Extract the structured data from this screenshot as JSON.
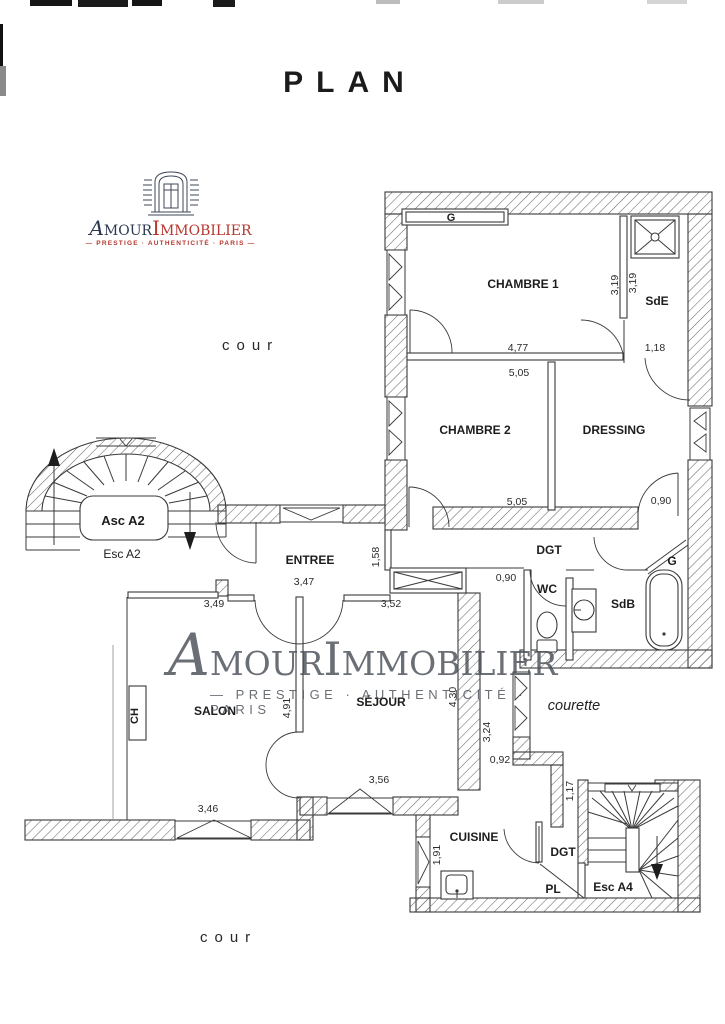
{
  "title": "PLAN",
  "logo": {
    "brand_first": "A",
    "brand_amour": "MOUR",
    "brand_i": "I",
    "brand_immobilier": "MMOBILIER",
    "tagline": "— PRESTIGE · AUTHENTICITÉ · PARIS —",
    "navy": "#2c3850",
    "red": "#b5372e"
  },
  "watermark": {
    "brand_first": "A",
    "brand_amour": "MOUR",
    "brand_i": "I",
    "brand_immobilier": "MMOBILIER",
    "tagline": "—  PRESTIGE · AUTHENTICITÉ · PARIS",
    "color": "#4a4f57"
  },
  "outdoor": {
    "cour_top": "cour",
    "cour_bottom": "cour",
    "courette": "courette"
  },
  "rooms": {
    "chambre1": "CHAMBRE 1",
    "chambre2": "CHAMBRE 2",
    "dressing": "DRESSING",
    "sde": "SdE",
    "sdb": "SdB",
    "wc": "WC",
    "entree": "ENTREE",
    "salon": "SALON",
    "sejour": "SÉJOUR",
    "cuisine": "CUISINE",
    "dgt_upper": "DGT",
    "dgt_lower": "DGT",
    "pl": "PL",
    "closet_top": "G",
    "closet_sdb": "G",
    "fireplace": "CH",
    "asc_a2": "Asc A2",
    "esc_a2": "Esc A2",
    "esc_a4": "Esc A4"
  },
  "dims": {
    "sde_left": "3,19",
    "sde_right": "3,19",
    "ch1_width": "4,77",
    "sde_width": "1,18",
    "ch2_top": "5,05",
    "ch2_bottom": "5,05",
    "dressing_door": "0,90",
    "wc_passage": "0,90",
    "entree_width": "3,47",
    "entree_right": "1,58",
    "entree_bottom": "3,52",
    "salon_top": "3,49",
    "salon_height": "4,91",
    "sejour_height": "4,30",
    "passage_height": "3,24",
    "passage_width": "0,92",
    "sejour_window": "3,56",
    "salon_window": "3,46",
    "stair_passage": "1,17",
    "cuisine_window": "1,91"
  }
}
